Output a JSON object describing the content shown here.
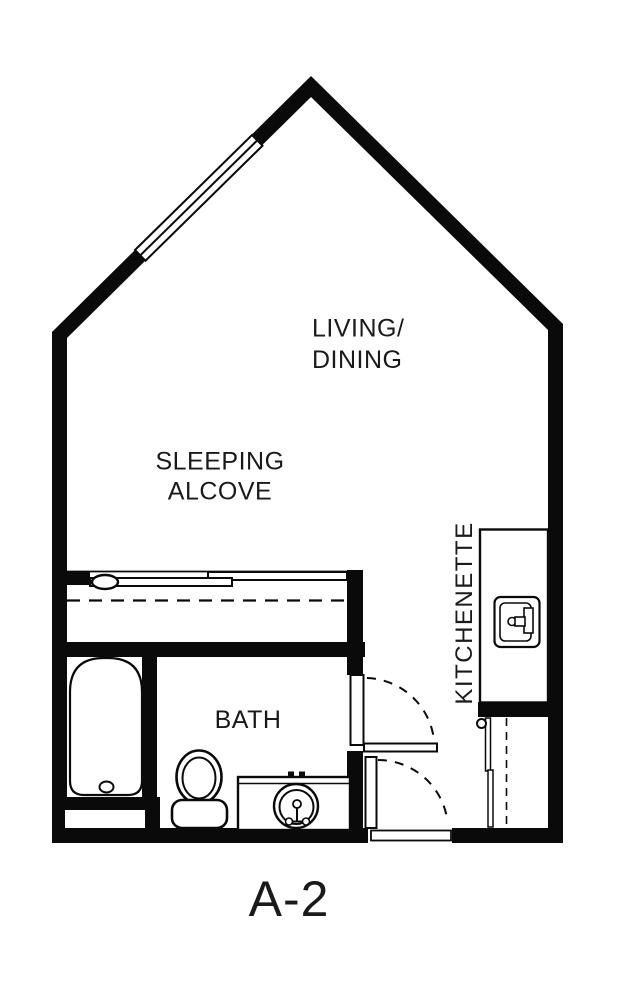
{
  "floorplan": {
    "unit_label": "A-2",
    "labels": {
      "living_dining_line1": "LIVING/",
      "living_dining_line2": "DINING",
      "sleeping_alcove_line1": "SLEEPING",
      "sleeping_alcove_line2": "ALCOVE",
      "bath": "BATH",
      "kitchenette": "KITCHENETTE"
    },
    "fixtures": {
      "window": "window-on-left-roof-wall",
      "sliding_closet_doors": "sliding-closet-doors",
      "overhead_dashed_line": "overhead-dashed-line",
      "bathtub": "bathtub",
      "toilet": "toilet",
      "vanity_sink": "vanity-sink",
      "bath_door": "bath-door-swing",
      "entry_door": "entry-door-swing",
      "kitchen_counter": "kitchen-counter",
      "kitchen_sink": "kitchen-sink",
      "appliance_space": "appliance-space-dashed"
    },
    "colors": {
      "wall": "#0a0a0a",
      "background": "#ffffff",
      "text": "#1a1a1a"
    }
  }
}
